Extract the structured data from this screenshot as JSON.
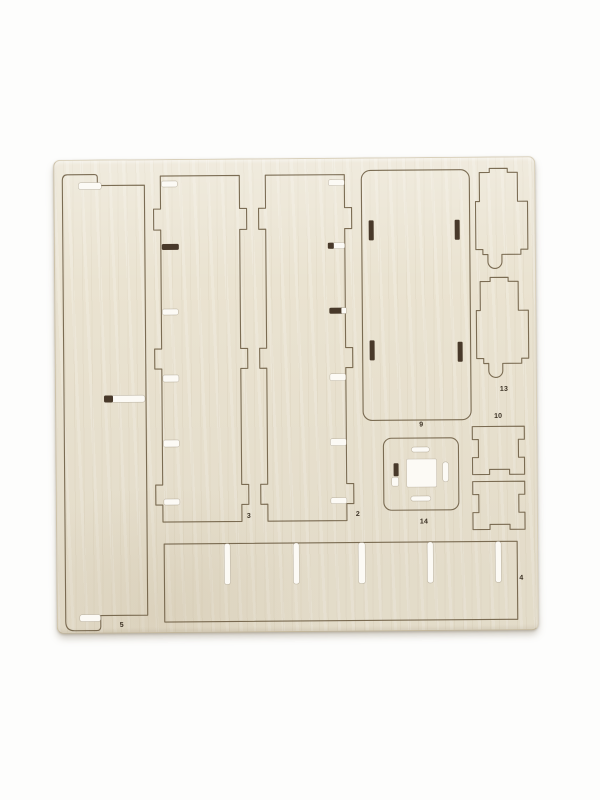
{
  "photo": {
    "subject": "laser-cut plywood model kit sheet on white background"
  },
  "piece_labels": {
    "p5": "5",
    "p3": "3",
    "p2": "2",
    "p9": "9",
    "p14": "14",
    "p13": "13",
    "p10": "10",
    "p4": "4"
  },
  "colors": {
    "background": "#fdfdfc",
    "sheet": "#eae3d1",
    "cut_line": "#6b5b41",
    "slot_light": "#fcfaf5",
    "slot_dark": "#48392a",
    "label_text": "#3a3023",
    "shadow": "rgba(130,118,95,0.4)"
  }
}
